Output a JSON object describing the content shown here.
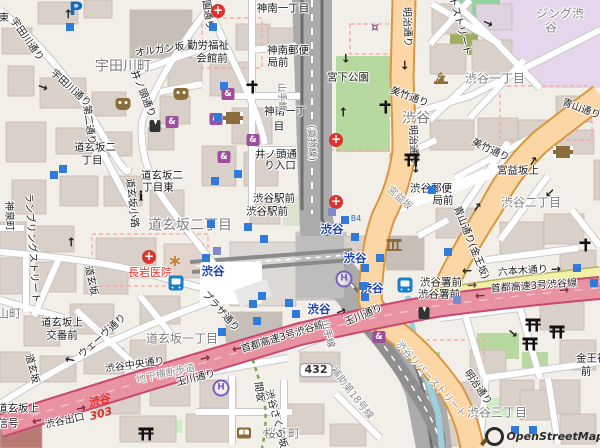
{
  "attribution": "OpenStreetMap",
  "colors": {
    "background": "#f2efe9",
    "building": "#d9d0c9",
    "primary_road": "#fcd6a4",
    "secondary_road": "#f1f0a6",
    "motorway": "#e892a2",
    "rail": "#a0a0a0",
    "park": "#b7d9a0",
    "retail_area": "#e6d6ec",
    "water": "#9ecfdd",
    "station_text": "#1b3fae",
    "hospital_red": "#d9352c",
    "poi_purple": "#9c4f9c",
    "poi_brown": "#8a6d3b"
  },
  "labels": [
    {
      "t": "宇田川町",
      "x": 123,
      "y": 67,
      "c": "dl",
      "r": 0,
      "n": "district-udagawacho"
    },
    {
      "t": "道玄坂二丁目",
      "x": 190,
      "y": 226,
      "c": "dl",
      "r": 0,
      "n": "district-dogenzaka2"
    },
    {
      "t": "道玄坂一丁目",
      "x": 182,
      "y": 339,
      "c": "d",
      "r": 0,
      "n": "district-dogenzaka1"
    },
    {
      "t": "渋谷",
      "x": 416,
      "y": 119,
      "c": "dl",
      "r": 0,
      "n": "district-shibuya"
    },
    {
      "t": "渋谷一丁目",
      "x": 495,
      "y": 79,
      "c": "d",
      "r": 0,
      "n": "district-shibuya1"
    },
    {
      "t": "渋谷二丁目",
      "x": 531,
      "y": 203,
      "c": "d",
      "r": 0,
      "n": "district-shibuya2"
    },
    {
      "t": "渋谷三丁目",
      "x": 497,
      "y": 413,
      "c": "d",
      "r": 0,
      "n": "district-shibuya3"
    },
    {
      "t": "桜丘町",
      "x": 282,
      "y": 434,
      "c": "d",
      "r": 0,
      "n": "district-sakuragaokacho"
    },
    {
      "t": "円山町",
      "x": 3,
      "y": 314,
      "c": "d",
      "r": 0,
      "n": "district-maruyamacho"
    },
    {
      "t": "ジング渋",
      "x": 560,
      "y": 14,
      "c": "d",
      "r": 0,
      "n": "building-name-line1"
    },
    {
      "t": "谷",
      "x": 551,
      "y": 28,
      "c": "d",
      "r": 0,
      "n": "building-name-line2"
    },
    {
      "t": "渋谷",
      "x": 213,
      "y": 271,
      "c": "st",
      "r": 0,
      "n": "station-shibuya"
    },
    {
      "t": "渋谷",
      "x": 332,
      "y": 229,
      "c": "st",
      "r": 0,
      "n": "station-shibuya"
    },
    {
      "t": "渋谷",
      "x": 355,
      "y": 258,
      "c": "st",
      "r": 0,
      "n": "station-shibuya"
    },
    {
      "t": "渋谷",
      "x": 372,
      "y": 288,
      "c": "st",
      "r": 0,
      "n": "station-shibuya"
    },
    {
      "t": "渋谷",
      "x": 319,
      "y": 309,
      "c": "st",
      "r": 0,
      "n": "station-shibuya"
    },
    {
      "t": "神南一丁目",
      "x": 283,
      "y": 9,
      "c": "b",
      "r": 0,
      "n": "busstop-jinnan1"
    },
    {
      "t": "勤労福祉",
      "x": 208,
      "y": 46,
      "c": "b",
      "r": 0,
      "n": "busstop-kinrofukushi"
    },
    {
      "t": "会館前",
      "x": 212,
      "y": 59,
      "c": "b",
      "r": 0,
      "n": "busstop-kaikanmae"
    },
    {
      "t": "神南郵便",
      "x": 288,
      "y": 51,
      "c": "b",
      "r": 0,
      "n": "busstop-jinnan-postoffice"
    },
    {
      "t": "局前",
      "x": 278,
      "y": 63,
      "c": "b",
      "r": 0,
      "n": "busstop-kyokumae"
    },
    {
      "t": "神南一丁",
      "x": 285,
      "y": 112,
      "c": "b",
      "r": 0,
      "n": "busstop-jinnan1b"
    },
    {
      "t": "目",
      "x": 279,
      "y": 127,
      "c": "b",
      "r": 0,
      "n": "busstop-jinnan1b2"
    },
    {
      "t": "井ノ頭通",
      "x": 276,
      "y": 155,
      "c": "b",
      "r": 0,
      "n": "busstop-inokashira-iriguchi"
    },
    {
      "t": "り入口",
      "x": 280,
      "y": 166,
      "c": "b",
      "r": 0,
      "n": "busstop-inokashira-iriguchi2"
    },
    {
      "t": "渋谷駅前",
      "x": 274,
      "y": 199,
      "c": "b",
      "r": 0,
      "n": "busstop-shibuya-ekimae"
    },
    {
      "t": "渋谷駅前",
      "x": 267,
      "y": 212,
      "c": "b",
      "r": 0,
      "n": "busstop-shibuya-ekimae2"
    },
    {
      "t": "道玄坂二",
      "x": 95,
      "y": 148,
      "c": "b",
      "r": 0,
      "n": "busstop-dogenzaka2"
    },
    {
      "t": "丁目",
      "x": 92,
      "y": 161,
      "c": "b",
      "r": 0,
      "n": "busstop-dogenzaka2b"
    },
    {
      "t": "道玄坂二",
      "x": 162,
      "y": 176,
      "c": "b",
      "r": 0,
      "n": "busstop-dogenzaka2higashi"
    },
    {
      "t": "丁目東",
      "x": 158,
      "y": 188,
      "c": "b",
      "r": 0,
      "n": "busstop-dogenzaka2higashi2"
    },
    {
      "t": "宮下公園",
      "x": 348,
      "y": 78,
      "c": "b",
      "r": 0,
      "n": "poi-miyashita-park"
    },
    {
      "t": "宮益坂上",
      "x": 518,
      "y": 171,
      "c": "b",
      "r": 0,
      "n": "busstop-miyamasuzaka-ue"
    },
    {
      "t": "渋谷郵便",
      "x": 431,
      "y": 189,
      "c": "b",
      "r": 0,
      "n": "busstop-shibuya-postoffice"
    },
    {
      "t": "局前",
      "x": 443,
      "y": 201,
      "c": "b",
      "r": 0,
      "n": "busstop-shibuya-postoffice2"
    },
    {
      "t": "渋谷署前",
      "x": 441,
      "y": 283,
      "c": "b",
      "r": 0,
      "n": "busstop-shibuyasho-mae"
    },
    {
      "t": "渋谷署前",
      "x": 439,
      "y": 295,
      "c": "b",
      "r": 0,
      "n": "busstop-shibuyasho-mae2"
    },
    {
      "t": "道玄坂上",
      "x": 62,
      "y": 323,
      "c": "b",
      "r": 0,
      "n": "busstop-dogenzakaue-koban"
    },
    {
      "t": "交番前",
      "x": 62,
      "y": 336,
      "c": "b",
      "r": 0,
      "n": "busstop-dogenzakaue-koban2"
    },
    {
      "t": "道玄坂上",
      "x": 18,
      "y": 409,
      "c": "b",
      "r": 0,
      "n": "busstop-dogenzaka-ue"
    },
    {
      "t": "信号",
      "x": 8,
      "y": 424,
      "c": "b",
      "r": 0,
      "n": "label-shingo"
    },
    {
      "t": "金王神社",
      "x": 597,
      "y": 359,
      "c": "b",
      "r": 0,
      "n": "busstop-konno-jinja"
    },
    {
      "t": "前",
      "x": 586,
      "y": 372,
      "c": "b",
      "r": 0,
      "n": "busstop-konno-jinja2"
    },
    {
      "t": "長岩医院",
      "x": 150,
      "y": 273,
      "c": "red",
      "r": 0,
      "n": "poi-nagaiwa-clinic"
    },
    {
      "t": "オルガン坂",
      "x": 160,
      "y": 51,
      "c": "s",
      "r": -8,
      "n": "street-organzaka"
    },
    {
      "t": "宇田川通り",
      "x": 26,
      "y": 40,
      "c": "s",
      "r": 55,
      "n": "street-udagawa-dori"
    },
    {
      "t": "宇田川通り",
      "x": 70,
      "y": 89,
      "c": "s",
      "r": 42,
      "n": "street-udagawa-dori2"
    },
    {
      "t": "井ノ頭通り",
      "x": 142,
      "y": 94,
      "c": "s",
      "r": 68,
      "n": "street-inokashira-dori"
    },
    {
      "t": "第二通り",
      "x": 88,
      "y": 125,
      "c": "s",
      "r": 82,
      "n": "street-daini-dori"
    },
    {
      "t": "公園通り",
      "x": 206,
      "y": 10,
      "c": "s",
      "r": 82,
      "n": "street-koen-dori"
    },
    {
      "t": "東",
      "x": 4,
      "y": 19,
      "c": "s",
      "r": 0,
      "n": "street-partial-east"
    },
    {
      "t": "神泉町",
      "x": 8,
      "y": 216,
      "c": "s",
      "r": 88,
      "n": "street-shinsencho"
    },
    {
      "t": "道玄坂小路",
      "x": 131,
      "y": 203,
      "c": "s",
      "r": 84,
      "n": "street-dogenzaka-koji"
    },
    {
      "t": "道玄坂",
      "x": 90,
      "y": 281,
      "c": "s",
      "r": 78,
      "n": "street-dogenzaka"
    },
    {
      "t": "道玄坂",
      "x": 31,
      "y": 369,
      "c": "s",
      "r": 76,
      "n": "street-dogenzaka2"
    },
    {
      "t": "ウェーヴ通り",
      "x": 103,
      "y": 337,
      "c": "s",
      "r": -42,
      "n": "street-wave-dori"
    },
    {
      "t": "渋谷中央通り",
      "x": 135,
      "y": 366,
      "c": "s",
      "r": -8,
      "n": "street-shibuya-chuo-dori"
    },
    {
      "t": "プラザ通り",
      "x": 220,
      "y": 312,
      "c": "s",
      "r": 48,
      "n": "street-plaza-dori"
    },
    {
      "t": "渋谷出口",
      "x": 65,
      "y": 422,
      "c": "s",
      "r": -12,
      "n": "street-shibuya-exit"
    },
    {
      "t": "玉川通り",
      "x": 196,
      "y": 379,
      "c": "s",
      "r": -14,
      "n": "street-tamagawa-dori"
    },
    {
      "t": "玉川通り",
      "x": 364,
      "y": 316,
      "c": "s",
      "r": -23,
      "n": "street-tamagawa-dori2"
    },
    {
      "t": "首都高速3号渋谷線",
      "x": 283,
      "y": 338,
      "c": "s",
      "r": -17,
      "n": "street-shuto-expwy3"
    },
    {
      "t": "首都高速3号渋谷線",
      "x": 534,
      "y": 287,
      "c": "s",
      "r": -4,
      "n": "street-shuto-expwy3b"
    },
    {
      "t": "六本木通り",
      "x": 523,
      "y": 272,
      "c": "s",
      "r": -4,
      "n": "street-roppongi-dori"
    },
    {
      "t": "明治通り",
      "x": 406,
      "y": 27,
      "c": "s",
      "r": 88,
      "n": "street-meiji-dori"
    },
    {
      "t": "明治通り",
      "x": 412,
      "y": 145,
      "c": "s",
      "r": 88,
      "n": "street-meiji-dori2"
    },
    {
      "t": "明治通り",
      "x": 477,
      "y": 388,
      "c": "s",
      "r": 55,
      "n": "street-meiji-dori3"
    },
    {
      "t": "美竹通り",
      "x": 409,
      "y": 98,
      "c": "s",
      "r": 20,
      "n": "street-mitake-dori"
    },
    {
      "t": "美竹通り",
      "x": 490,
      "y": 151,
      "c": "s",
      "r": 25,
      "n": "street-mitake-dori2"
    },
    {
      "t": "青山通り",
      "x": 581,
      "y": 110,
      "c": "s",
      "r": 20,
      "n": "street-aoyama-dori"
    },
    {
      "t": "青山通り(金王坂)",
      "x": 470,
      "y": 243,
      "c": "s",
      "r": 68,
      "n": "street-aoyama-konnozaka"
    },
    {
      "t": "宮益坂",
      "x": 399,
      "y": 199,
      "c": "sg",
      "r": 42,
      "n": "street-miyamasuzaka"
    },
    {
      "t": "地下横断歩道",
      "x": 166,
      "y": 375,
      "c": "sg",
      "r": -12,
      "n": "street-underpass"
    },
    {
      "t": "補助第18号線",
      "x": 351,
      "y": 394,
      "c": "sg",
      "r": 52,
      "n": "street-hojo18"
    },
    {
      "t": "渋谷リバーストリート",
      "x": 430,
      "y": 380,
      "c": "sg",
      "r": 48,
      "n": "street-river-street"
    },
    {
      "t": "渋谷さくら坂",
      "x": 275,
      "y": 419,
      "c": "s",
      "r": 75,
      "n": "street-sakurazaka"
    },
    {
      "t": "間坂",
      "x": 258,
      "y": 392,
      "c": "s",
      "r": 82,
      "n": "street-masaka"
    },
    {
      "t": "キャットストリート",
      "x": 455,
      "y": 12,
      "c": "s",
      "r": 75,
      "n": "street-cat-street"
    },
    {
      "t": "ランブリングストリート",
      "x": 31,
      "y": 248,
      "c": "s",
      "r": 86,
      "n": "street-rambling-street"
    },
    {
      "t": "山手線",
      "x": 281,
      "y": 97,
      "c": "rl",
      "r": 88,
      "n": "rail-yamanote"
    },
    {
      "t": "(貨物線)",
      "x": 311,
      "y": 143,
      "c": "rl",
      "r": 88,
      "n": "rail-freight"
    },
    {
      "t": "山手線",
      "x": 327,
      "y": 334,
      "c": "rl",
      "r": 75,
      "n": "rail-yamanote2"
    },
    {
      "t": "B4",
      "x": 356,
      "y": 219,
      "c": "ex",
      "r": 0,
      "n": "subway-exit-b4"
    },
    {
      "t": "渋谷",
      "x": 99,
      "y": 401,
      "c": "ref",
      "r": -15,
      "n": "expwy-ref-shibuya"
    },
    {
      "t": "303",
      "x": 101,
      "y": 414,
      "c": "ref",
      "r": -15,
      "n": "expwy-ref-303"
    },
    {
      "t": "432",
      "x": 316,
      "y": 370,
      "c": "shield",
      "r": 0,
      "n": "route-shield-432"
    }
  ],
  "icons": [
    {
      "k": "hospital",
      "x": 218,
      "y": 11
    },
    {
      "k": "hospital",
      "x": 336,
      "y": 140
    },
    {
      "k": "hospital",
      "x": 336,
      "y": 202
    },
    {
      "k": "hospital",
      "x": 149,
      "y": 257
    },
    {
      "k": "parking",
      "x": 76,
      "y": 9
    },
    {
      "k": "bus",
      "x": 176,
      "y": 283
    },
    {
      "k": "bus",
      "x": 405,
      "y": 285
    },
    {
      "k": "hotel",
      "x": 344,
      "y": 279
    },
    {
      "k": "hotel",
      "x": 221,
      "y": 388
    },
    {
      "k": "museum",
      "x": 394,
      "y": 245
    },
    {
      "k": "theater",
      "x": 123,
      "y": 104
    },
    {
      "k": "theater",
      "x": 181,
      "y": 94
    },
    {
      "k": "cinema",
      "x": 233,
      "y": 118
    },
    {
      "k": "cinema",
      "x": 563,
      "y": 152
    },
    {
      "k": "library",
      "x": 244,
      "y": 433
    },
    {
      "k": "cart",
      "x": 375,
      "y": 28
    },
    {
      "k": "clothes",
      "x": 172,
      "y": 122
    },
    {
      "k": "clothes",
      "x": 228,
      "y": 94
    },
    {
      "k": "clothes",
      "x": 216,
      "y": 119
    },
    {
      "k": "clothes",
      "x": 253,
      "y": 140
    },
    {
      "k": "clothes",
      "x": 224,
      "y": 157
    },
    {
      "k": "clothes",
      "x": 379,
      "y": 337
    },
    {
      "k": "suit",
      "x": 155,
      "y": 126
    },
    {
      "k": "suit",
      "x": 424,
      "y": 313
    },
    {
      "k": "torii",
      "x": 412,
      "y": 160
    },
    {
      "k": "torii",
      "x": 146,
      "y": 434
    },
    {
      "k": "torii",
      "x": 533,
      "y": 325
    },
    {
      "k": "torii",
      "x": 557,
      "y": 332
    },
    {
      "k": "torii",
      "x": 530,
      "y": 344
    },
    {
      "k": "church",
      "x": 252,
      "y": 87
    },
    {
      "k": "church",
      "x": 385,
      "y": 107
    },
    {
      "k": "church",
      "x": 585,
      "y": 245
    },
    {
      "k": "temple",
      "x": 441,
      "y": 78
    },
    {
      "k": "info",
      "x": 141,
      "y": 197
    },
    {
      "k": "attraction",
      "x": 175,
      "y": 265
    },
    {
      "k": "entrance",
      "x": 70,
      "y": 27
    },
    {
      "k": "entrance",
      "x": 213,
      "y": 27
    },
    {
      "k": "entrance",
      "x": 224,
      "y": 86
    },
    {
      "k": "entrance",
      "x": 218,
      "y": 118
    },
    {
      "k": "entrance",
      "x": 63,
      "y": 169
    },
    {
      "k": "entrance",
      "x": 54,
      "y": 175
    },
    {
      "k": "entrance",
      "x": 215,
      "y": 181
    },
    {
      "k": "entrance",
      "x": 238,
      "y": 174
    },
    {
      "k": "entrance",
      "x": 211,
      "y": 224
    },
    {
      "k": "entrance",
      "x": 248,
      "y": 227
    },
    {
      "k": "entrance",
      "x": 206,
      "y": 258
    },
    {
      "k": "entrance",
      "x": 264,
      "y": 239
    },
    {
      "k": "entrance",
      "x": 253,
      "y": 304
    },
    {
      "k": "entrance",
      "x": 262,
      "y": 296
    },
    {
      "k": "entrance",
      "x": 289,
      "y": 303
    },
    {
      "k": "entrance",
      "x": 296,
      "y": 314
    },
    {
      "k": "entrance",
      "x": 257,
      "y": 321
    },
    {
      "k": "entrance",
      "x": 222,
      "y": 332
    },
    {
      "k": "entrance",
      "x": 345,
      "y": 220
    },
    {
      "k": "entrance",
      "x": 355,
      "y": 237
    },
    {
      "k": "entrance",
      "x": 380,
      "y": 258
    },
    {
      "k": "entrance",
      "x": 365,
      "y": 268
    },
    {
      "k": "entrance",
      "x": 363,
      "y": 286
    },
    {
      "k": "entrance",
      "x": 365,
      "y": 297
    },
    {
      "k": "entrance",
      "x": 432,
      "y": 190
    },
    {
      "k": "entrance",
      "x": 448,
      "y": 252
    },
    {
      "k": "entrance",
      "x": 577,
      "y": 268
    },
    {
      "k": "entrance",
      "x": 594,
      "y": 283
    },
    {
      "k": "entrance",
      "x": 515,
      "y": 430
    },
    {
      "k": "entrance",
      "x": 533,
      "y": 430
    },
    {
      "k": "slate",
      "x": 332,
      "y": 212
    },
    {
      "k": "slate",
      "x": 217,
      "y": 251
    },
    {
      "k": "slate",
      "x": 457,
      "y": 300
    },
    {
      "k": "arrow",
      "x": 68,
      "y": 14,
      "r": -90
    },
    {
      "k": "arrow",
      "x": 43,
      "y": 87,
      "r": 20
    },
    {
      "k": "arrow",
      "x": 71,
      "y": 242,
      "r": -90
    },
    {
      "k": "arrow",
      "x": 70,
      "y": 360,
      "r": -170
    },
    {
      "k": "arrow",
      "x": 346,
      "y": 58,
      "r": 90
    },
    {
      "k": "arrow",
      "x": 343,
      "y": 112,
      "r": -90
    },
    {
      "k": "arrow",
      "x": 405,
      "y": 65,
      "r": 90
    },
    {
      "k": "arrow",
      "x": 416,
      "y": 168,
      "r": 90
    },
    {
      "k": "arrow",
      "x": 533,
      "y": 161,
      "r": -60
    },
    {
      "k": "arrow",
      "x": 550,
      "y": 193,
      "r": 135
    },
    {
      "k": "arrow",
      "x": 488,
      "y": 23,
      "r": 25
    },
    {
      "k": "arrow",
      "x": 513,
      "y": 333,
      "r": 40
    },
    {
      "k": "arrow",
      "x": 477,
      "y": 207,
      "r": -55
    },
    {
      "k": "arrow",
      "x": 341,
      "y": 311,
      "r": -22
    },
    {
      "k": "arrow",
      "x": 467,
      "y": 271,
      "r": 177
    },
    {
      "k": "arrow",
      "x": 556,
      "y": 269,
      "r": -3
    },
    {
      "k": "arrow-exp",
      "x": 37,
      "y": 421,
      "r": 165
    },
    {
      "k": "arrow-exp",
      "x": 81,
      "y": 408,
      "r": -12
    },
    {
      "k": "arrow-exp",
      "x": 205,
      "y": 358,
      "r": -13
    },
    {
      "k": "arrow-exp",
      "x": 237,
      "y": 349,
      "r": 168
    },
    {
      "k": "arrow-exp",
      "x": 472,
      "y": 285,
      "r": -4
    },
    {
      "k": "arrow-exp",
      "x": 480,
      "y": 296,
      "r": 176
    },
    {
      "k": "arrow-exp",
      "x": 564,
      "y": 290,
      "r": -4
    }
  ]
}
